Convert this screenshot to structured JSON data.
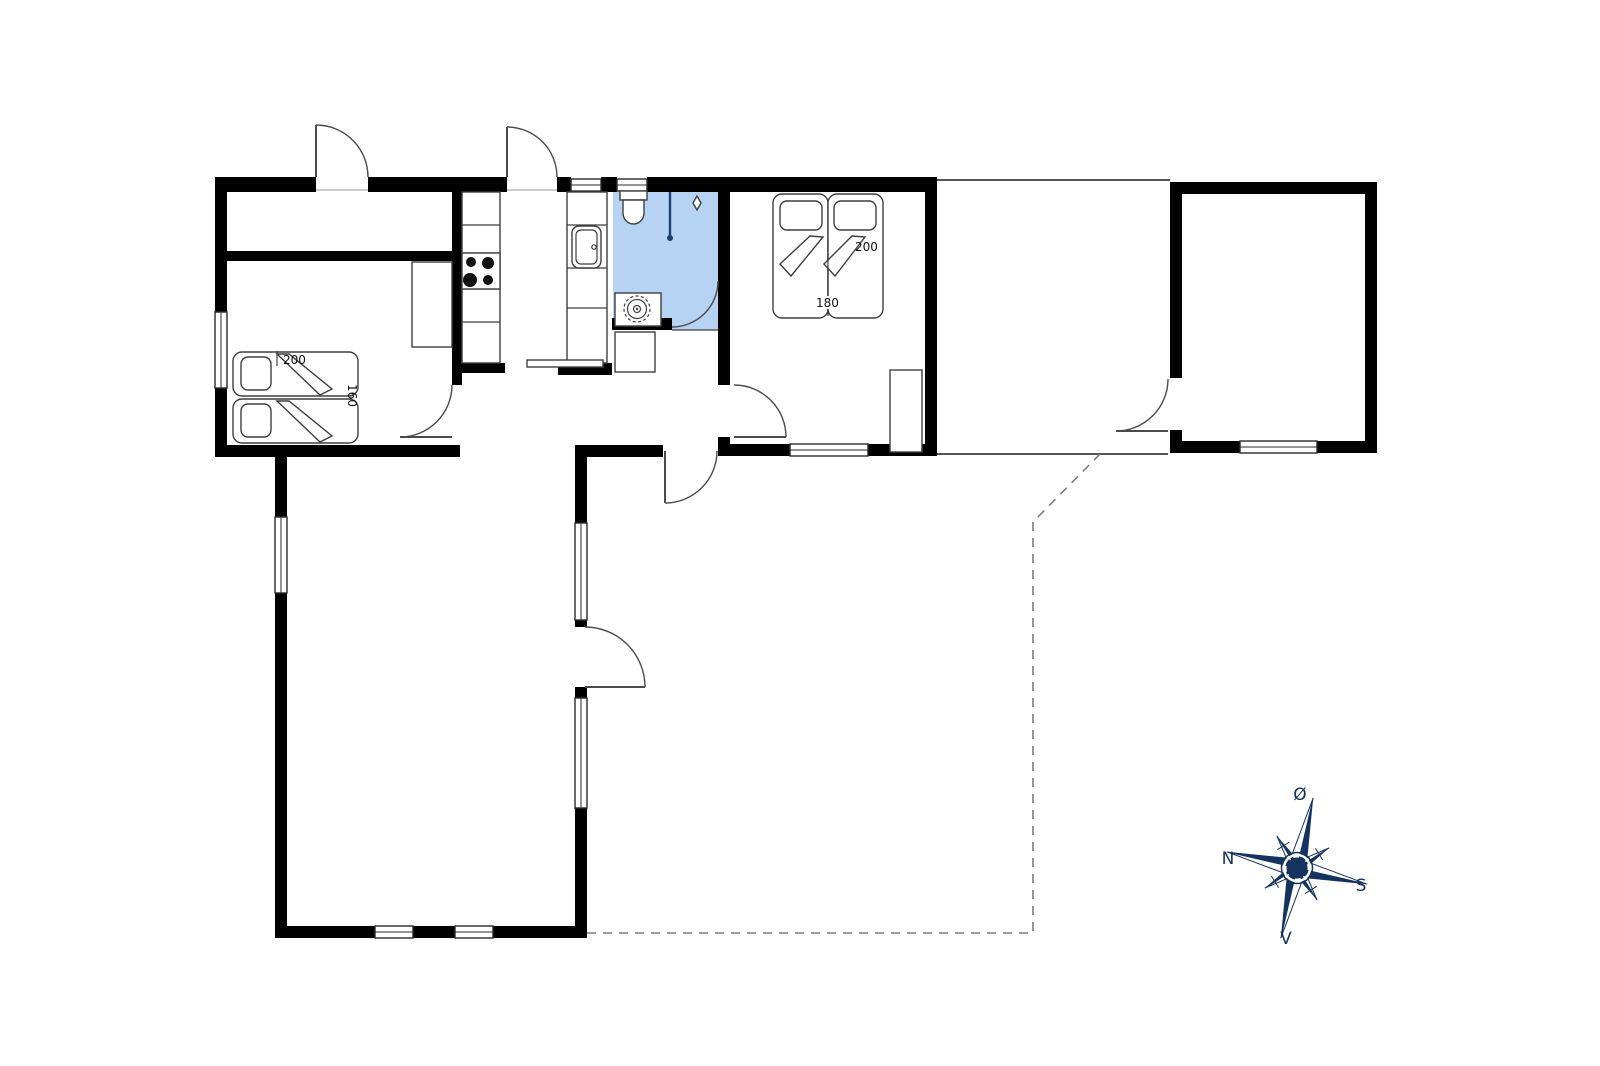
{
  "colors": {
    "background": "#ffffff",
    "walls": "#000000",
    "bathroom_floor": "#b7d3f4",
    "fixtures": "#3f3f3f",
    "doors": "#4a4a4a",
    "dashed_boundary": "#7d7d7d",
    "shower": "#1d3f6d",
    "compass": "#14335f",
    "label_text": "#111111"
  },
  "beds": {
    "bedroom_left": {
      "length_label": "200",
      "width_label": "160"
    },
    "bedroom_right": {
      "length_label": "200",
      "width_label": "180"
    }
  },
  "compass": {
    "north": "N",
    "south": "S",
    "west": "V",
    "east": "Ø"
  }
}
